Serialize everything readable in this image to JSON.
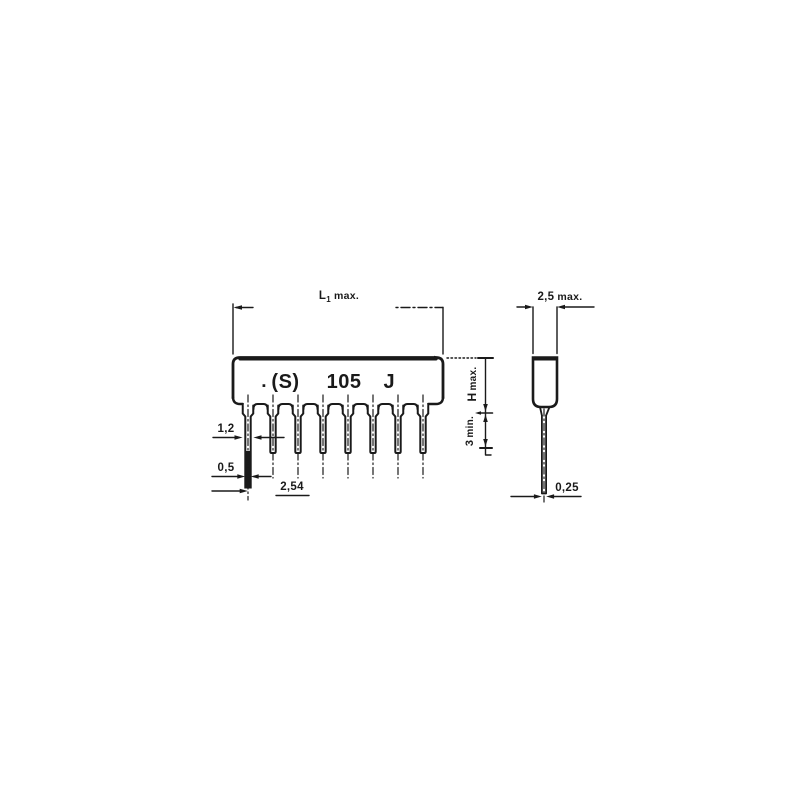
{
  "diagram": {
    "front_view": {
      "marking": {
        "dot": "▪",
        "parts": [
          "(S)",
          "105",
          "J"
        ]
      },
      "dim_length": {
        "base": "L",
        "sub": "1",
        "unit": "max."
      },
      "dim_height": {
        "base": "H",
        "unit": "max."
      },
      "dim_lead_min": {
        "base": "3",
        "unit": "min."
      },
      "dim_neck_width": "1,2",
      "dim_lead_width": "0,5",
      "dim_pitch": "2,54"
    },
    "side_view": {
      "dim_body_width": {
        "base": "2,5",
        "unit": "max."
      },
      "dim_lead_thickness": "0,25"
    },
    "colors": {
      "ink": "#1a1a1a",
      "background": "#ffffff"
    }
  }
}
